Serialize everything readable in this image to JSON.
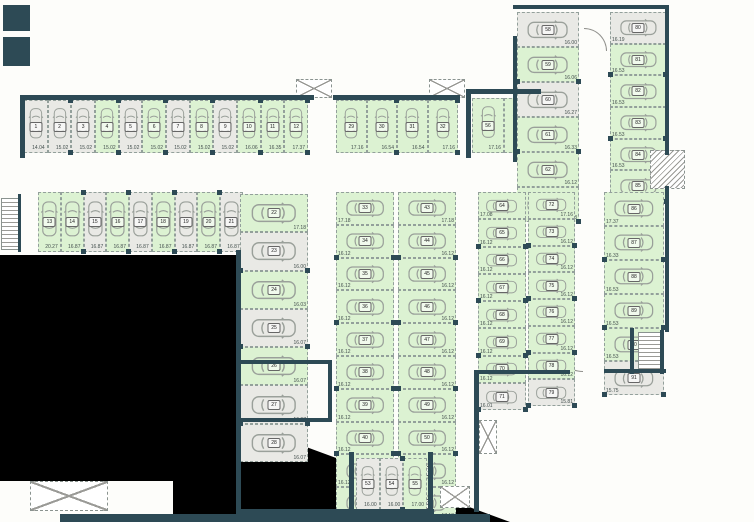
{
  "colors": {
    "free": "#dcf2d2",
    "occupied": "#e9e9e5",
    "wall": "#2d4a55",
    "outside": "#000000"
  },
  "icons": {
    "car": "top-view-car-outline"
  },
  "groups": [
    {
      "id": "gA",
      "label": "row-1-12",
      "spaces": [
        {
          "n": "1",
          "area": "14.04",
          "state": "occupied"
        },
        {
          "n": "2",
          "area": "15.02",
          "state": "occupied"
        },
        {
          "n": "3",
          "area": "15.02",
          "state": "occupied"
        },
        {
          "n": "4",
          "area": "15.02",
          "state": "free"
        },
        {
          "n": "5",
          "area": "15.02",
          "state": "occupied"
        },
        {
          "n": "6",
          "area": "15.02",
          "state": "free"
        },
        {
          "n": "7",
          "area": "15.02",
          "state": "occupied"
        },
        {
          "n": "8",
          "area": "15.02",
          "state": "free"
        },
        {
          "n": "9",
          "area": "15.02",
          "state": "occupied"
        },
        {
          "n": "10",
          "area": "16.06",
          "state": "free"
        },
        {
          "n": "11",
          "area": "16.35",
          "state": "free"
        },
        {
          "n": "12",
          "area": "17.37",
          "state": "free"
        }
      ]
    },
    {
      "id": "gB",
      "label": "row-13-21",
      "spaces": [
        {
          "n": "13",
          "area": "20.27",
          "state": "free"
        },
        {
          "n": "14",
          "area": "16.87",
          "state": "free"
        },
        {
          "n": "15",
          "area": "16.87",
          "state": "occupied"
        },
        {
          "n": "16",
          "area": "16.87",
          "state": "free"
        },
        {
          "n": "17",
          "area": "16.87",
          "state": "occupied"
        },
        {
          "n": "18",
          "area": "16.87",
          "state": "free"
        },
        {
          "n": "19",
          "area": "16.87",
          "state": "occupied"
        },
        {
          "n": "20",
          "area": "16.87",
          "state": "free"
        },
        {
          "n": "21",
          "area": "16.87",
          "state": "occupied"
        }
      ]
    },
    {
      "id": "gC",
      "label": "column-22-28",
      "spaces": [
        {
          "n": "22",
          "area": "17.18",
          "state": "free"
        },
        {
          "n": "23",
          "area": "16.00",
          "state": "occupied"
        },
        {
          "n": "24",
          "area": "16.03",
          "state": "free"
        },
        {
          "n": "25",
          "area": "16.07",
          "state": "occupied"
        },
        {
          "n": "26",
          "area": "16.07",
          "state": "free"
        },
        {
          "n": "27",
          "area": "16.07",
          "state": "occupied"
        },
        {
          "n": "28",
          "area": "16.07",
          "state": "occupied"
        }
      ]
    },
    {
      "id": "gD",
      "label": "row-29-32",
      "spaces": [
        {
          "n": "29",
          "area": "17.16",
          "state": "free"
        },
        {
          "n": "30",
          "area": "16.54",
          "state": "free"
        },
        {
          "n": "31",
          "area": "16.54",
          "state": "free"
        },
        {
          "n": "32",
          "area": "17.16",
          "state": "free"
        }
      ]
    },
    {
      "id": "gE",
      "label": "column-33-42",
      "spaces": [
        {
          "n": "33",
          "area": "17.18",
          "state": "free"
        },
        {
          "n": "34",
          "area": "16.12",
          "state": "free"
        },
        {
          "n": "35",
          "area": "16.12",
          "state": "free"
        },
        {
          "n": "36",
          "area": "16.12",
          "state": "free"
        },
        {
          "n": "37",
          "area": "16.12",
          "state": "free"
        },
        {
          "n": "38",
          "area": "16.12",
          "state": "free"
        },
        {
          "n": "39",
          "area": "16.12",
          "state": "free"
        },
        {
          "n": "40",
          "area": "16.12",
          "state": "free"
        },
        {
          "n": "41",
          "area": "16.12",
          "state": "free"
        },
        {
          "n": "42",
          "area": "17.18",
          "state": "free"
        }
      ]
    },
    {
      "id": "gF",
      "label": "column-43-52",
      "spaces": [
        {
          "n": "43",
          "area": "17.18",
          "state": "free"
        },
        {
          "n": "44",
          "area": "16.12",
          "state": "free"
        },
        {
          "n": "45",
          "area": "16.12",
          "state": "free"
        },
        {
          "n": "46",
          "area": "16.12",
          "state": "free"
        },
        {
          "n": "47",
          "area": "16.12",
          "state": "free"
        },
        {
          "n": "48",
          "area": "16.12",
          "state": "free"
        },
        {
          "n": "49",
          "area": "16.12",
          "state": "free"
        },
        {
          "n": "50",
          "area": "16.12",
          "state": "free"
        },
        {
          "n": "51",
          "area": "16.12",
          "state": "free"
        },
        {
          "n": "52",
          "area": "17.18",
          "state": "free"
        }
      ]
    },
    {
      "id": "gG",
      "label": "row-53-55",
      "spaces": [
        {
          "n": "53",
          "area": "16.00",
          "state": "occupied"
        },
        {
          "n": "54",
          "area": "16.00",
          "state": "occupied"
        },
        {
          "n": "55",
          "area": "17.00",
          "state": "free"
        }
      ]
    },
    {
      "id": "gH",
      "label": "row-56-57",
      "spaces": [
        {
          "n": "56",
          "area": "17.16",
          "state": "free"
        },
        {
          "n": "57",
          "area": "16.54",
          "state": "free"
        }
      ]
    },
    {
      "id": "gI",
      "label": "column-58-63",
      "spaces": [
        {
          "n": "58",
          "area": "16.00",
          "state": "occupied"
        },
        {
          "n": "59",
          "area": "16.06",
          "state": "free"
        },
        {
          "n": "60",
          "area": "16.27",
          "state": "occupied"
        },
        {
          "n": "61",
          "area": "16.33",
          "state": "free"
        },
        {
          "n": "62",
          "area": "16.12",
          "state": "free"
        },
        {
          "n": "63",
          "area": "17.08",
          "state": "free"
        }
      ]
    },
    {
      "id": "gJ",
      "label": "column-64-71",
      "spaces": [
        {
          "n": "64",
          "area": "17.08",
          "state": "free"
        },
        {
          "n": "65",
          "area": "16.12",
          "state": "free"
        },
        {
          "n": "66",
          "area": "16.12",
          "state": "free"
        },
        {
          "n": "67",
          "area": "16.12",
          "state": "free"
        },
        {
          "n": "68",
          "area": "16.12",
          "state": "free"
        },
        {
          "n": "69",
          "area": "16.12",
          "state": "free"
        },
        {
          "n": "70",
          "area": "16.12",
          "state": "free"
        },
        {
          "n": "71",
          "area": "16.01",
          "state": "occupied"
        }
      ]
    },
    {
      "id": "gK",
      "label": "column-72-79",
      "spaces": [
        {
          "n": "72",
          "area": "17.16",
          "state": "free"
        },
        {
          "n": "73",
          "area": "16.12",
          "state": "free"
        },
        {
          "n": "74",
          "area": "16.12",
          "state": "free"
        },
        {
          "n": "75",
          "area": "16.12",
          "state": "free"
        },
        {
          "n": "76",
          "area": "16.12",
          "state": "free"
        },
        {
          "n": "77",
          "area": "16.12",
          "state": "free"
        },
        {
          "n": "78",
          "area": "16.12",
          "state": "free"
        },
        {
          "n": "79",
          "area": "15.81",
          "state": "occupied"
        }
      ]
    },
    {
      "id": "gL",
      "label": "column-80-85",
      "spaces": [
        {
          "n": "80",
          "area": "16.19",
          "state": "occupied"
        },
        {
          "n": "81",
          "area": "16.53",
          "state": "free"
        },
        {
          "n": "82",
          "area": "16.53",
          "state": "free"
        },
        {
          "n": "83",
          "area": "16.53",
          "state": "free"
        },
        {
          "n": "84",
          "area": "16.53",
          "state": "free"
        },
        {
          "n": "85",
          "area": "17.37",
          "state": "free"
        }
      ]
    },
    {
      "id": "gM",
      "label": "column-86-91",
      "spaces": [
        {
          "n": "86",
          "area": "17.37",
          "state": "free"
        },
        {
          "n": "87",
          "area": "16.33",
          "state": "free"
        },
        {
          "n": "88",
          "area": "16.53",
          "state": "free"
        },
        {
          "n": "89",
          "area": "16.53",
          "state": "free"
        },
        {
          "n": "90",
          "area": "16.53",
          "state": "free"
        },
        {
          "n": "91",
          "area": "15.75",
          "state": "occupied"
        }
      ]
    }
  ]
}
